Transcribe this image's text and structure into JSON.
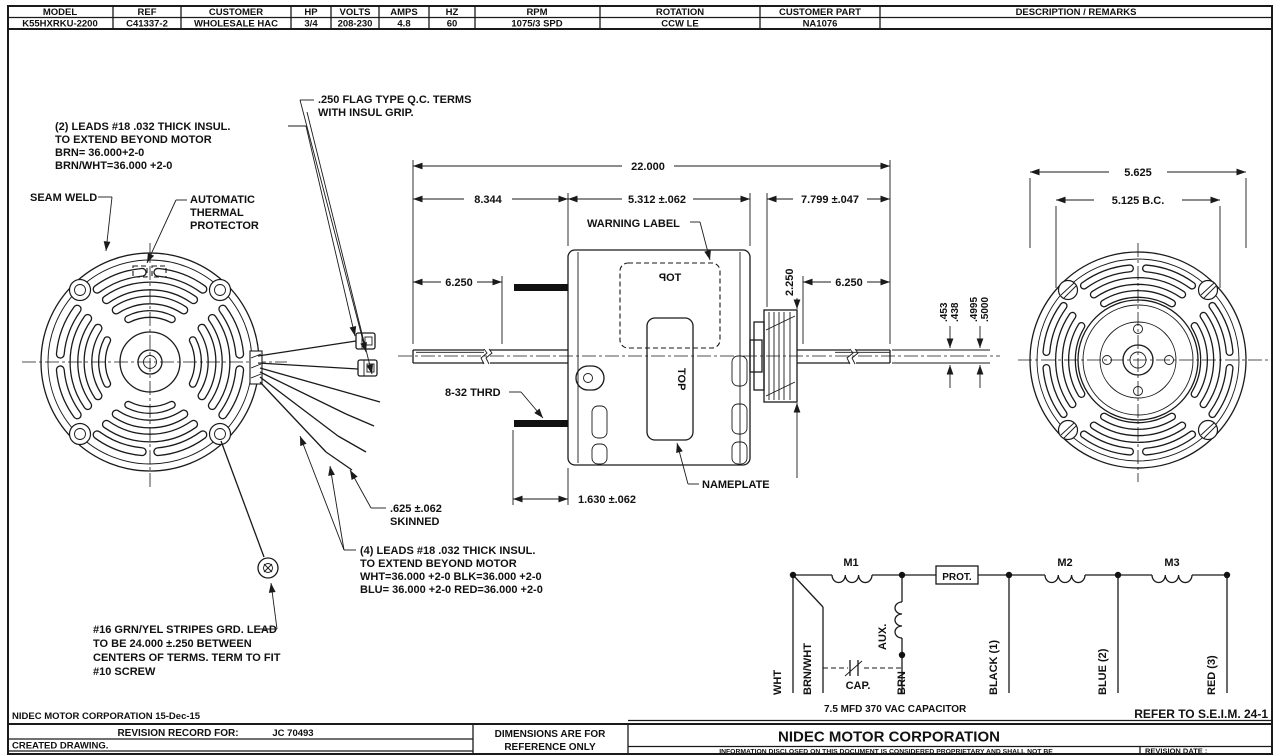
{
  "table": {
    "cols": [
      {
        "h": "MODEL",
        "v": "K55HXRKU-2200"
      },
      {
        "h": "REF",
        "v": "C41337-2"
      },
      {
        "h": "CUSTOMER",
        "v": "WHOLESALE HAC"
      },
      {
        "h": "HP",
        "v": "3/4"
      },
      {
        "h": "VOLTS",
        "v": "208-230"
      },
      {
        "h": "AMPS",
        "v": "4.8"
      },
      {
        "h": "HZ",
        "v": "60"
      },
      {
        "h": "RPM",
        "v": "1075/3 SPD"
      },
      {
        "h": "ROTATION",
        "v": "CCW LE"
      },
      {
        "h": "CUSTOMER PART",
        "v": "NA1076"
      },
      {
        "h": "DESCRIPTION / REMARKS",
        "v": ""
      }
    ]
  },
  "notes": {
    "flag_terms": [
      ".250 FLAG TYPE Q.C. TERMS",
      "WITH INSUL GRIP."
    ],
    "leads2": [
      "(2) LEADS #18 .032 THICK INSUL.",
      "TO EXTEND BEYOND MOTOR",
      "BRN= 36.000+2-0",
      "BRN/WHT=36.000 +2-0"
    ],
    "seam_weld": "SEAM WELD",
    "thermal": [
      "AUTOMATIC",
      "THERMAL",
      "PROTECTOR"
    ],
    "warning_label": "WARNING LABEL",
    "nameplate": "NAMEPLATE",
    "thrd": "8-32 THRD",
    "skinned": [
      ".625 ±.062",
      "SKINNED"
    ],
    "leads4": [
      "(4) LEADS #18 .032 THICK INSUL.",
      "TO EXTEND BEYOND MOTOR",
      "WHT=36.000 +2-0 BLK=36.000 +2-0",
      "BLU= 36.000 +2-0 RED=36.000 +2-0"
    ],
    "ground": [
      "#16 GRN/YEL STRIPES GRD. LEAD",
      "TO BE 24.000 ±.250 BETWEEN",
      "CENTERS OF TERMS. TERM TO FIT",
      "#10 SCREW"
    ],
    "top_mirrored": "TOP",
    "top_vertical": "TOP"
  },
  "dims": {
    "overall": "22.000",
    "d8344": "8.344",
    "d5312": "5.312 ±.062",
    "d7799": "7.799 ±.047",
    "d6250L": "6.250",
    "d6250R": "6.250",
    "d2250": "2.250",
    "d453": ".453",
    "d438": ".438",
    "d4995": ".4995",
    "d5000": ".5000",
    "d1630": "1.630 ±.062",
    "d5625": "5.625",
    "dbc": "5.125  B.C."
  },
  "schematic": {
    "m1": "M1",
    "m2": "M2",
    "m3": "M3",
    "prot": "PROT.",
    "aux": "AUX.",
    "cap": "CAP.",
    "wht": "WHT",
    "brnwht": "BRN/WHT",
    "brn": "BRN",
    "black": "BLACK (1)",
    "blue": "BLUE (2)",
    "red": "RED (3)",
    "cap_note": "7.5 MFD 370 VAC CAPACITOR",
    "refer": "REFER TO S.E.I.M. 24-1"
  },
  "titleblock": {
    "left_header": "NIDEC MOTOR CORPORATION 15-Dec-15",
    "revision_record": "REVISION RECORD FOR:",
    "jc": "JC 70493",
    "created": "CREATED DRAWING.",
    "dims_ref": [
      "DIMENSIONS ARE FOR",
      "REFERENCE ONLY"
    ],
    "company": "NIDEC MOTOR CORPORATION",
    "proprietary": "INFORMATION DISCLOSED ON THIS DOCUMENT IS CONSIDERED PROPRIETARY AND SHALL NOT BE",
    "revision_date": "REVISION DATE :"
  }
}
